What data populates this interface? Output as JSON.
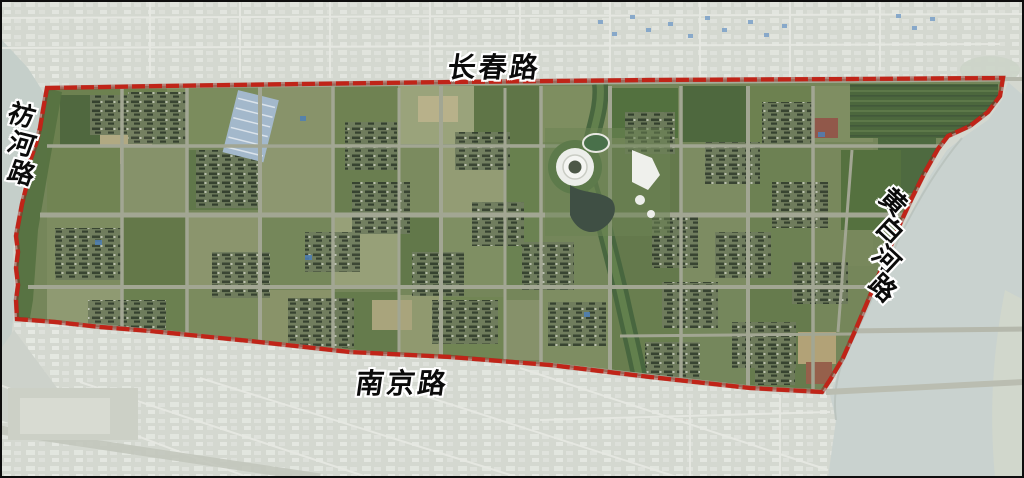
{
  "figure": {
    "kind": "annotated satellite map of a planning area",
    "frame_border_color": "#0d0d0d",
    "label_ink_color": "#0b0b0b",
    "label_halo_color": "#ffffff"
  },
  "boundary": {
    "name": "red dashed planning-area boundary",
    "color": "#c02418",
    "style": "dashed",
    "points": [
      [
        47,
        88
      ],
      [
        160,
        86
      ],
      [
        300,
        84
      ],
      [
        452,
        82
      ],
      [
        650,
        80
      ],
      [
        850,
        79
      ],
      [
        1003,
        78
      ],
      [
        1000,
        96
      ],
      [
        988,
        112
      ],
      [
        970,
        126
      ],
      [
        948,
        136
      ],
      [
        938,
        149
      ],
      [
        925,
        172
      ],
      [
        912,
        198
      ],
      [
        900,
        224
      ],
      [
        889,
        250
      ],
      [
        878,
        277
      ],
      [
        867,
        303
      ],
      [
        855,
        331
      ],
      [
        843,
        358
      ],
      [
        830,
        380
      ],
      [
        822,
        392
      ],
      [
        750,
        388
      ],
      [
        650,
        377
      ],
      [
        550,
        365
      ],
      [
        450,
        357
      ],
      [
        350,
        352
      ],
      [
        250,
        341
      ],
      [
        150,
        331
      ],
      [
        100,
        327
      ],
      [
        55,
        322
      ],
      [
        17,
        319
      ],
      [
        16,
        300
      ],
      [
        18,
        285
      ],
      [
        16,
        268
      ],
      [
        18,
        252
      ],
      [
        16,
        236
      ],
      [
        19,
        220
      ],
      [
        22,
        204
      ],
      [
        26,
        188
      ],
      [
        24,
        172
      ],
      [
        31,
        158
      ],
      [
        36,
        144
      ],
      [
        40,
        128
      ],
      [
        43,
        110
      ]
    ]
  },
  "road_labels": {
    "top": {
      "text": "长春路"
    },
    "left": {
      "text": "祊河路"
    },
    "right": {
      "text": "黄白河路"
    },
    "bottom": {
      "text": "南京路"
    }
  }
}
